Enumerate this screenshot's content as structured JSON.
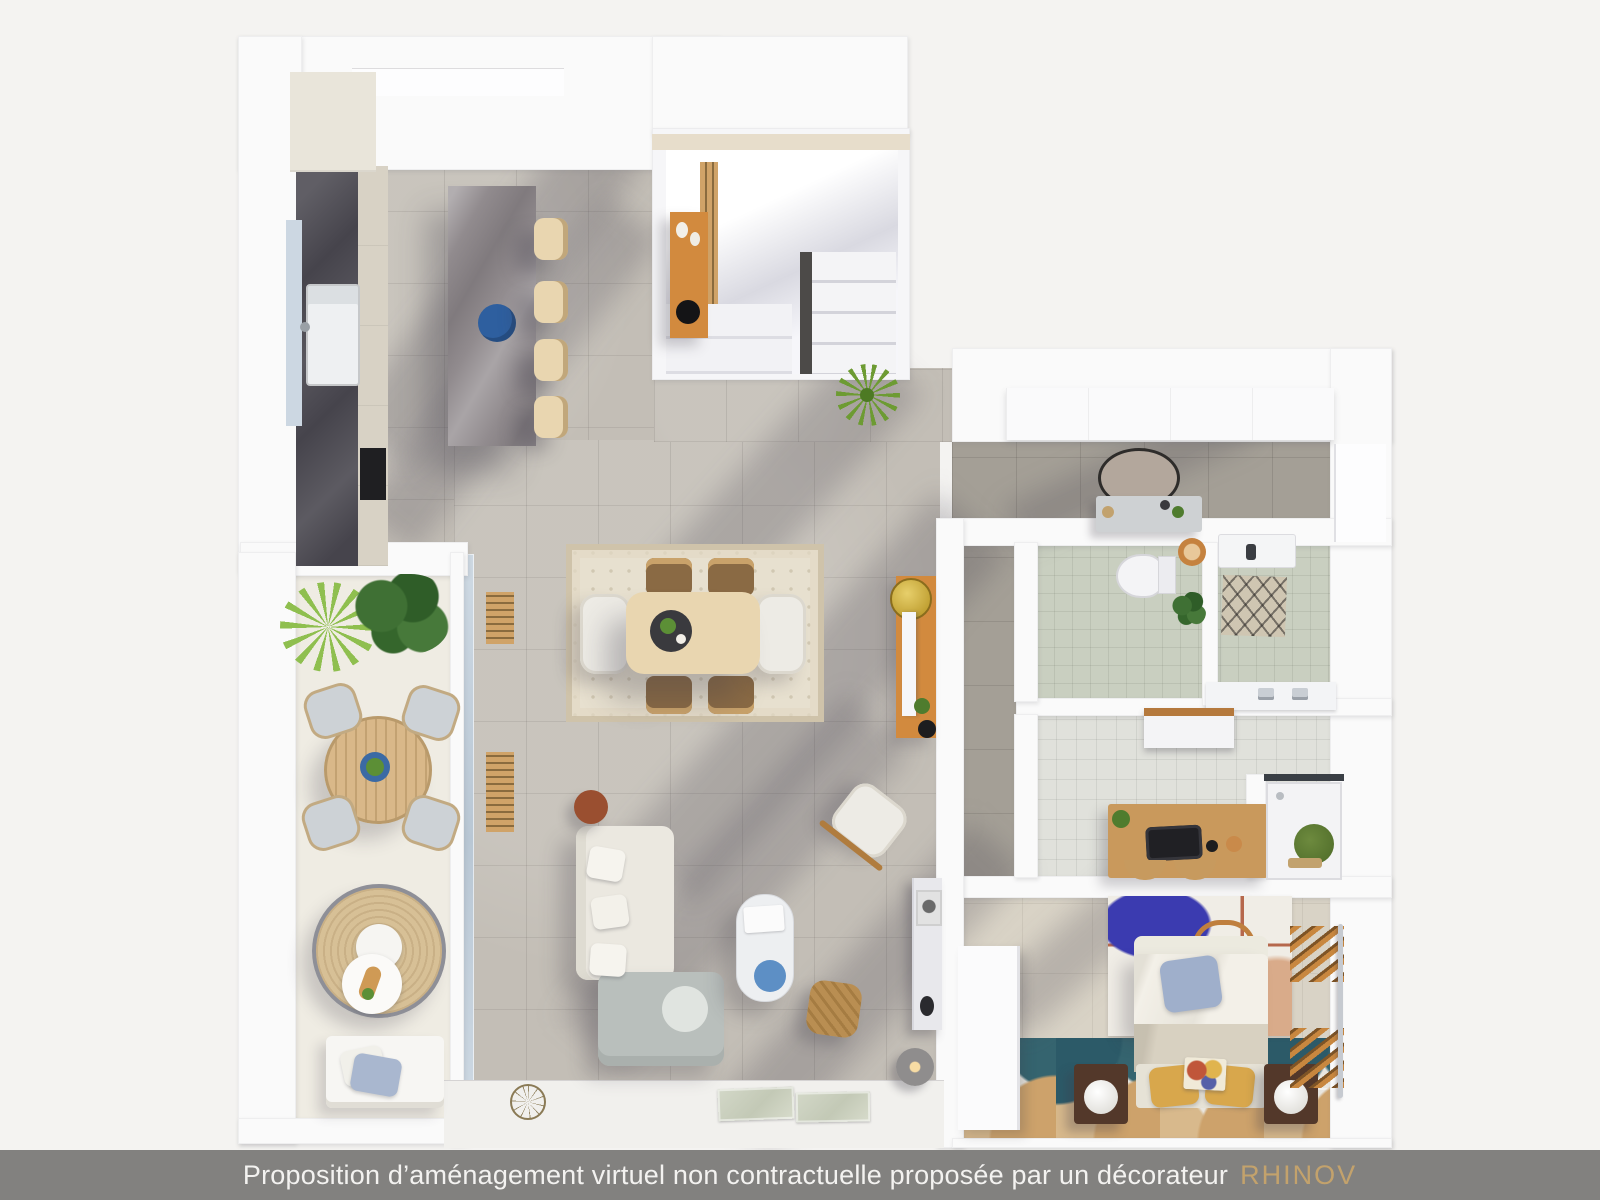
{
  "scene": {
    "type": "3d-floor-plan-top-view",
    "rooms": [
      "kitchen",
      "staircase",
      "entry",
      "balcony",
      "dining-area",
      "living-room",
      "hallway",
      "toilet",
      "laundry",
      "bathroom",
      "shower",
      "bedroom"
    ]
  },
  "footer": {
    "caption": "Proposition d’aménagement virtuel non contractuelle proposée par un décorateur",
    "brand": "RHINOV"
  },
  "palette": {
    "background": "#f4f3f1",
    "wall_white": "#fafafa",
    "wall_light": "#f1f0ed",
    "tile_light": "#c3beb6",
    "tile_dark": "#a49f96",
    "tile_sage": "#c9cfc0",
    "tile_bath": "#e0e1db",
    "floor_balcony": "#efece3",
    "floor_bedroom": "#d9d3c6",
    "counter_dark": "#46444c",
    "island_marble": "#918b8e",
    "wood_warm": "#d28a3e",
    "wood_light": "#e9d6b0",
    "wood_desk": "#c9995c",
    "sofa_cream": "#ebe8e0",
    "sofa_gray": "#b9bfbc",
    "rug_cream": "#e7e0cf",
    "accent_blue": "#2e5f9f",
    "tray_blue": "#5d8fc5",
    "pillow_blue": "#9fafcb",
    "mustard": "#d8a74c",
    "terracotta": "#9a4f30",
    "plant_green": "#6d9b33",
    "plant_dark": "#3c6b34",
    "brass": "#c2a26e",
    "tile_teal": "#2c5a68",
    "tile_tan": "#cda26b",
    "glass_blue": "#c6d2dd",
    "shadow_tint": "rgba(62,58,72,0.22)",
    "footer_bar": "#82817f",
    "footer_text": "#f3f2f0",
    "brand_gold": "#c3a26c"
  }
}
